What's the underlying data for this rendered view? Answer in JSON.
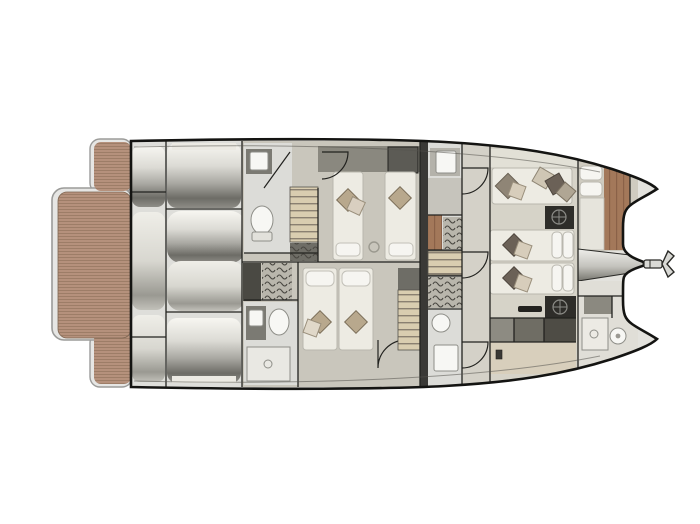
{
  "diagram": {
    "kind": "yacht-floor-plan",
    "view": "top-down deck plan of a power catamaran, bow pointing right",
    "depicted_elements": [
      "aft swim platform with teak planking",
      "tender garage with stowed dinghy rollers",
      "aft guest bathroom with toilet and sink",
      "twin guest cabin with two single beds",
      "double guest cabin with two beds",
      "forward guest bathroom with shower",
      "companionway stairs",
      "wardrobes with hanger rails",
      "mid bathrooms upper and lower",
      "corridor with three door swings",
      "owner lounge sofa with cushions",
      "two forward berths with pillows",
      "two dark cocktail tables with compass motif",
      "galley console blocks",
      "bow berth with pillow stack",
      "bow bathroom with toilet and basin",
      "foredeck wedge between catamaran bows",
      "anchor on bow roller"
    ]
  },
  "colors": {
    "background": "#ffffff",
    "hull_outline": "#141412",
    "wall": "#22221f",
    "interior_base": "#e3e2dd",
    "wood_deck": "#b5917c",
    "wood_bow": "#a3785a",
    "platform_rim": "#e6e6e4",
    "rim_edge": "#9b9b99",
    "garage_floor": "#dededa",
    "cabin_floor": "#c9c6bc",
    "corridor_floor": "#d4d1c8",
    "salon_floor": "#d6d3c8",
    "salon_floor_aft": "#d8cfbc",
    "bath_floor": "#dcdcd8",
    "dark_panel": "#6e6d66",
    "darker_panel": "#4a4943",
    "bulkhead": "#3a3936",
    "headboard": "#8a887f",
    "hatch_dark": "#5c5b55",
    "bed": "#edebe3",
    "bed_stroke": "#b9b7ae",
    "pillow_tan": "#b8a88d",
    "pillow_taupe": "#8f8576",
    "pillow_dark": "#6b6157",
    "pillow_white": "#f6f5f1",
    "stairs": "#d9cdb0",
    "hanger_bg": "#b9b6ac",
    "table_dark": "#2e2d29",
    "compass": "#8b8b86",
    "galley_a": "#8d8b82",
    "galley_b": "#6f6d64",
    "galley_c": "#4e4c45",
    "fixture_white": "#f7f7f4",
    "fixture_stroke": "#8e8e88",
    "anchor_fill": "#d9d9d5",
    "counter_dark": "#7b7a73"
  }
}
